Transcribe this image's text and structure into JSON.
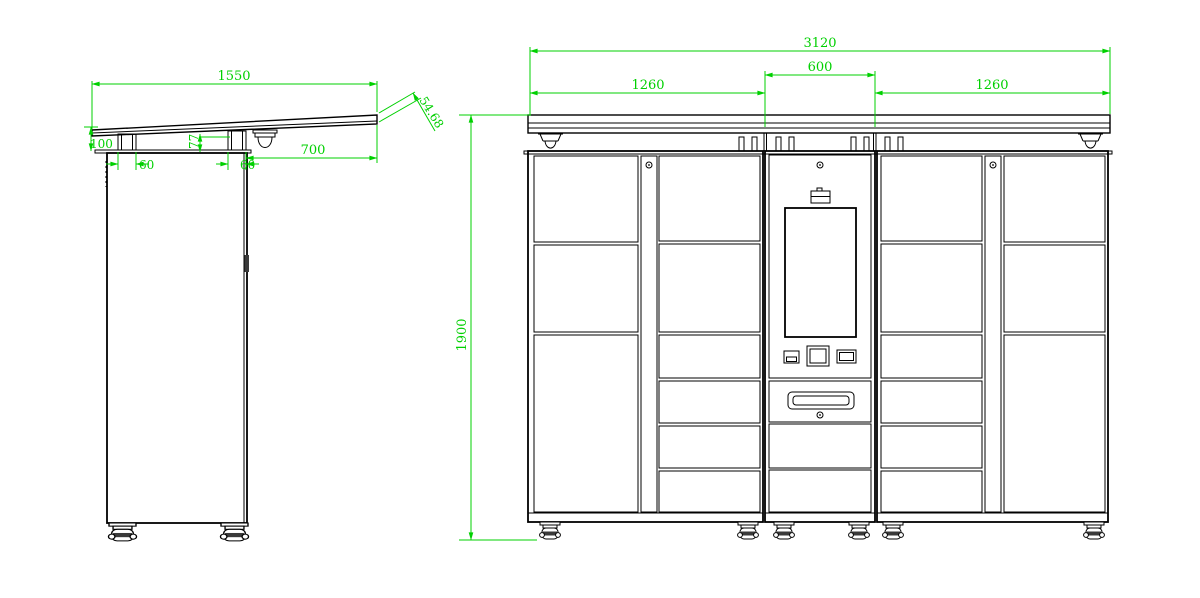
{
  "drawing": {
    "type": "technical-drawing",
    "views": {
      "side_view": {
        "dims": {
          "tabletop_width": "1550",
          "front_edge_thickness": "54.68",
          "apron_height": "100",
          "left_post_width": "60",
          "right_post_width": "60",
          "riser_height": "77",
          "overhang_depth": "700"
        }
      },
      "front_view": {
        "dims": {
          "overall_width": "3120",
          "left_section_width": "1260",
          "center_section_width": "600",
          "right_section_width": "1260",
          "overall_height": "1900"
        }
      }
    },
    "colors": {
      "dimension": "#00d000",
      "line": "#000000",
      "background": "#ffffff"
    }
  }
}
